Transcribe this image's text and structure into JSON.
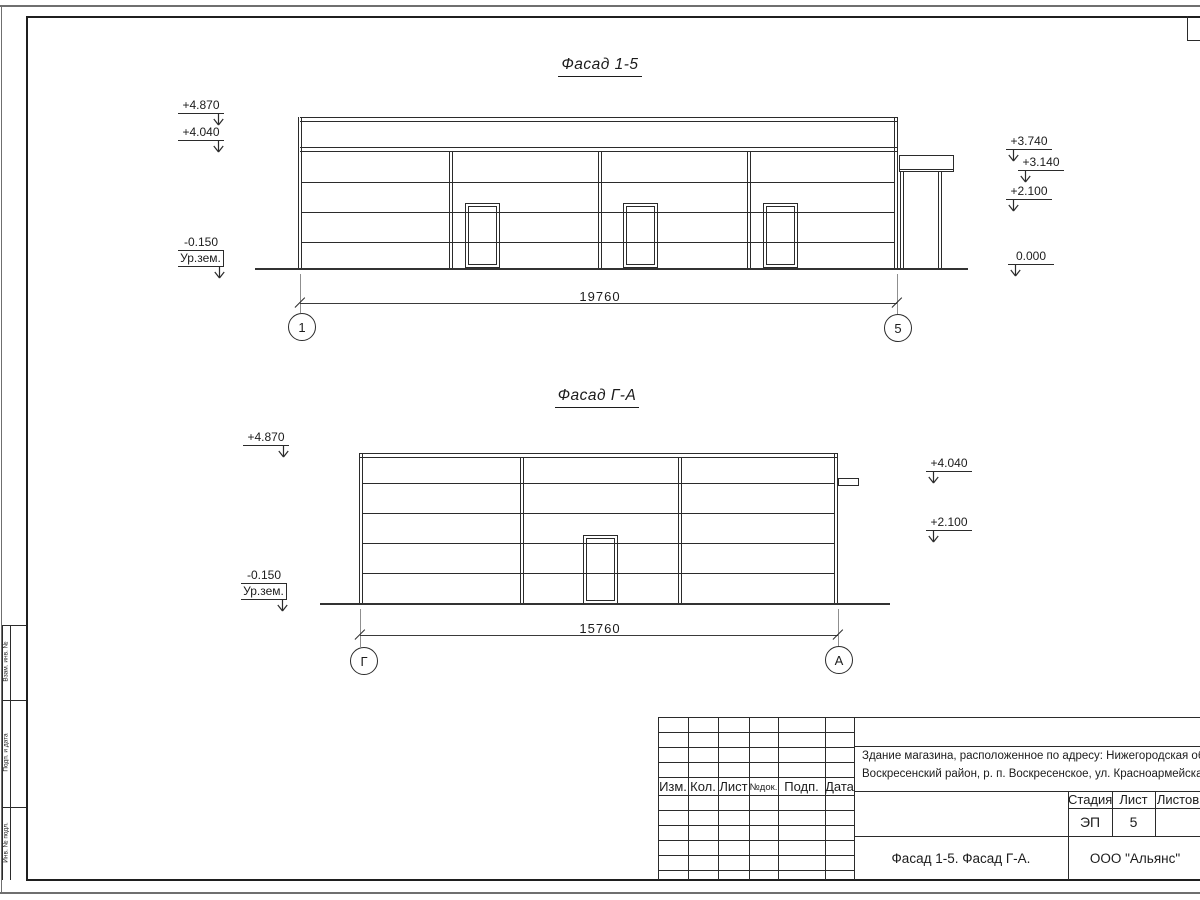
{
  "sheet": {
    "margin_labels": [
      "Взам. инв. №",
      "Подп. и дата",
      "Инв. № подл."
    ]
  },
  "facade_top": {
    "title": "Фасад 1-5",
    "marks_left": [
      "+4.870",
      "+4.040"
    ],
    "ground_mark": {
      "value": "-0.150",
      "label": "Ур.зем."
    },
    "marks_right": [
      "+3.740",
      "+3.140",
      "+2.100",
      "0.000"
    ],
    "dimension": "19760",
    "axis_left": "1",
    "axis_right": "5"
  },
  "facade_bottom": {
    "title": "Фасад Г-А",
    "marks_left": [
      "+4.870"
    ],
    "ground_mark": {
      "value": "-0.150",
      "label": "Ур.зем."
    },
    "marks_right": [
      "+4.040",
      "+2.100"
    ],
    "dimension": "15760",
    "axis_left": "Г",
    "axis_right": "А"
  },
  "title_block": {
    "revision_headers": [
      "Изм.",
      "Кол.",
      "Лист",
      "№док.",
      "Подп.",
      "Дата"
    ],
    "project_name": [
      "Здание магазина, расположенное по адресу: Нижегородская область,",
      "Воскресенский район, р. п. Воскресенское, ул. Красноармейская, д. 1"
    ],
    "stage_header": "Стадия",
    "sheet_header": "Лист",
    "sheets_header": "Листов",
    "stage": "ЭП",
    "sheet_number": "5",
    "drawing_title": "Фасад 1-5. Фасад Г-А.",
    "company": "ООО \"Альянс\""
  },
  "colors": {
    "line": "#2b2b2b",
    "frame_outer": "#6f6f6f",
    "extension": "#8f8f8f"
  }
}
